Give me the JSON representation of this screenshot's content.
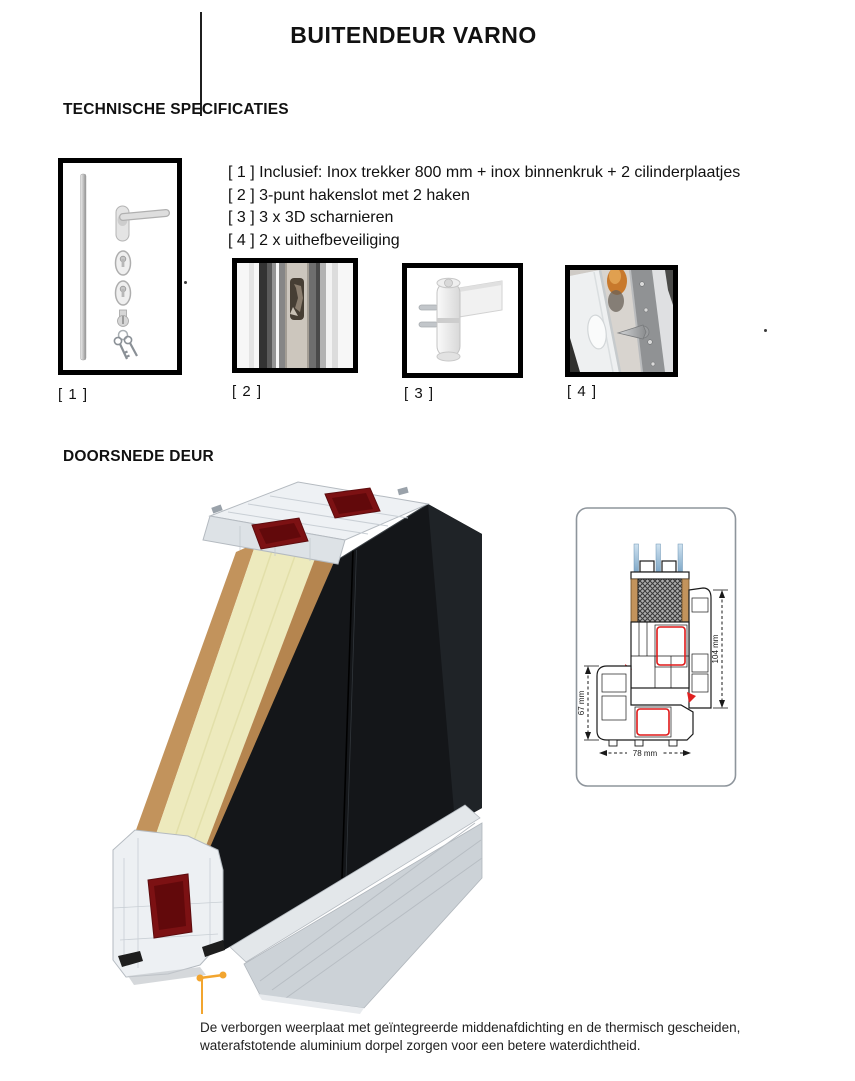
{
  "title": "BUITENDEUR VARNO",
  "specs": {
    "heading": "TECHNISCHE SPECIFICATIES",
    "items": [
      "[ 1 ] Inclusief: Inox trekker 800 mm + inox binnenkruk + 2 cilinderplaatjes",
      "[ 2 ] 3-punt hakenslot met 2 haken",
      "[ 3 ] 3 x 3D scharnieren",
      "[ 4 ] 2 x uithefbeveiliging"
    ]
  },
  "figures": [
    {
      "label": "[ 1 ]",
      "name": "inox-trekker-en-beslag-set"
    },
    {
      "label": "[ 2 ]",
      "name": "hakenslot-close-up"
    },
    {
      "label": "[ 3 ]",
      "name": "3d-scharnier"
    },
    {
      "label": "[ 4 ]",
      "name": "uithefbeveiliging-foto"
    }
  ],
  "cross_section": {
    "heading": "DOORSNEDE DEUR",
    "diagram_dimensions": {
      "right": "104 mm",
      "left": "67 mm",
      "bottom": "78 mm"
    },
    "caption_line1": "De verborgen weerplaat met geïntegreerde middenafdichting en de thermisch gescheiden,",
    "caption_line2": "waterafstotende aluminium dorpel zorgen voor een betere waterdichtheid."
  },
  "colors": {
    "panel_core_cream": "#edeabd",
    "panel_skin_tan": "#c2935c",
    "door_leaf_black": "#141619",
    "reinforcement_red": "#7c1113",
    "callout_orange": "#f2a52f",
    "diagram_seal_red": "#e02020",
    "glass_blue": "#7fa8c8",
    "frame_border_black": "#000000"
  }
}
